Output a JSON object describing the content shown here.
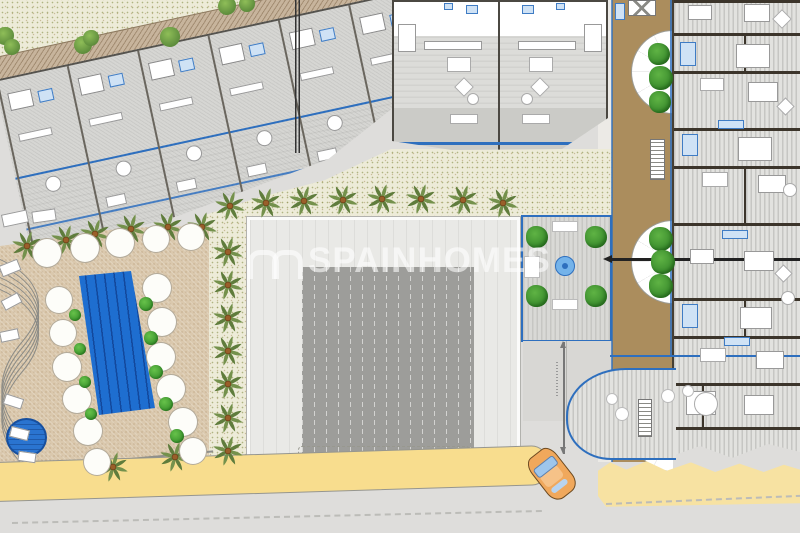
{
  "meta": {
    "kind": "architectural-site-plan",
    "width": 800,
    "height": 533
  },
  "watermark": {
    "text": "SPAINHOMES",
    "logo": "double-arch-icon",
    "color": "#ffffff",
    "opacity": 0.58
  },
  "palette": {
    "road": "#dedddb",
    "gravel": "#edebd8",
    "deck": "#dac8ad",
    "walkway": "#c7b49c",
    "roof_light": "#e9e9e6",
    "roof_dark": "#9d9d9a",
    "pool_blue": "#1e6ed0",
    "promenade_yellow": "#f8dd8e",
    "sand": "#f7e2a2",
    "wood_deck": "#ab8d5d",
    "accent_blue": "#2e6fbe",
    "fixture_blue": "#cfe2f5",
    "vegetation_green": "#3f9830",
    "palm_frond": "#74914c",
    "palm_trunk": "#9a5f2a",
    "car_orange": "#f0a85c"
  },
  "features": {
    "palms": [
      [
        230,
        206
      ],
      [
        266,
        203
      ],
      [
        304,
        201
      ],
      [
        343,
        200
      ],
      [
        382,
        199
      ],
      [
        421,
        199
      ],
      [
        463,
        200
      ],
      [
        503,
        203
      ],
      [
        228,
        252
      ],
      [
        228,
        285
      ],
      [
        228,
        318
      ],
      [
        228,
        351
      ],
      [
        228,
        384
      ],
      [
        228,
        418
      ],
      [
        228,
        451
      ],
      [
        27,
        246
      ],
      [
        66,
        240
      ],
      [
        95,
        234
      ],
      [
        131,
        229
      ],
      [
        168,
        227
      ],
      [
        202,
        227
      ],
      [
        113,
        467
      ],
      [
        175,
        457
      ]
    ],
    "umbrellas": [
      [
        46,
        252,
        14
      ],
      [
        84,
        247,
        14
      ],
      [
        119,
        242,
        14
      ],
      [
        155,
        238,
        13
      ],
      [
        190,
        236,
        13
      ],
      [
        58,
        299,
        13
      ],
      [
        62,
        332,
        13
      ],
      [
        66,
        366,
        14
      ],
      [
        76,
        398,
        14
      ],
      [
        87,
        430,
        14
      ],
      [
        96,
        461,
        13
      ],
      [
        156,
        287,
        14
      ],
      [
        161,
        321,
        14
      ],
      [
        160,
        356,
        14
      ],
      [
        170,
        388,
        14
      ],
      [
        182,
        421,
        14
      ],
      [
        192,
        450,
        13
      ]
    ],
    "bushes": [
      [
        75,
        315,
        6
      ],
      [
        80,
        349,
        6
      ],
      [
        85,
        382,
        6
      ],
      [
        91,
        414,
        6
      ],
      [
        146,
        304,
        7
      ],
      [
        151,
        338,
        7
      ],
      [
        156,
        372,
        7
      ],
      [
        166,
        404,
        7
      ],
      [
        177,
        436,
        7
      ]
    ],
    "gravelBushes": [
      [
        5,
        36,
        9
      ],
      [
        12,
        47,
        8
      ],
      [
        83,
        45,
        9
      ],
      [
        91,
        38,
        8
      ],
      [
        170,
        37,
        10
      ],
      [
        227,
        6,
        9
      ],
      [
        247,
        4,
        8
      ]
    ],
    "trees": [
      [
        659,
        54,
        11
      ],
      [
        661,
        78,
        12
      ],
      [
        660,
        102,
        11
      ],
      [
        661,
        239,
        12
      ],
      [
        663,
        262,
        12
      ],
      [
        661,
        286,
        12
      ],
      [
        537,
        237,
        11
      ],
      [
        596,
        237,
        11
      ],
      [
        537,
        296,
        11
      ],
      [
        596,
        296,
        11
      ]
    ],
    "rightWalls": [
      0,
      33,
      71,
      128,
      166,
      223,
      298,
      336,
      383,
      427
    ],
    "rightWallSegs": [
      [
        742,
        33,
        38
      ],
      [
        742,
        166,
        57
      ],
      [
        742,
        298,
        38
      ],
      [
        700,
        383,
        44
      ]
    ],
    "stripUnitCount": 6,
    "stripUnitTemplate": {
      "bed": [
        4,
        14,
        24,
        18
      ],
      "bath": [
        34,
        18,
        15,
        12
      ],
      "kitchen": [
        6,
        56,
        34,
        8
      ],
      "table": [
        22,
        104,
        16,
        16
      ],
      "lounger": [
        6,
        136,
        20,
        11
      ]
    },
    "shapes": [
      [
        "r",
        398,
        24,
        18,
        28,
        0,
        "#ffffff",
        "#999"
      ],
      [
        "r",
        584,
        24,
        18,
        28,
        0,
        "#ffffff",
        "#999"
      ],
      [
        "r",
        424,
        41,
        58,
        9,
        0,
        "#ffffff",
        "#999"
      ],
      [
        "r",
        518,
        41,
        58,
        9,
        0,
        "#ffffff",
        "#999"
      ],
      [
        "r",
        447,
        57,
        24,
        15,
        0,
        "#ffffff",
        "#aaa"
      ],
      [
        "r",
        529,
        57,
        24,
        15,
        0,
        "#ffffff",
        "#aaa"
      ],
      [
        "r",
        457,
        80,
        14,
        14,
        45,
        "#ffffff",
        "#aaa"
      ],
      [
        "r",
        533,
        80,
        14,
        14,
        45,
        "#ffffff",
        "#aaa"
      ],
      [
        "c",
        473,
        99,
        6,
        "#ffffff",
        "#aaa"
      ],
      [
        "c",
        527,
        99,
        6,
        "#ffffff",
        "#aaa"
      ],
      [
        "r",
        450,
        114,
        28,
        10,
        0,
        "#ffffff",
        "#aaa"
      ],
      [
        "r",
        522,
        114,
        28,
        10,
        0,
        "#ffffff",
        "#aaa"
      ],
      [
        "r",
        466,
        5,
        12,
        9,
        0,
        "#cfe2f5",
        "#3f7cc4"
      ],
      [
        "r",
        522,
        5,
        12,
        9,
        0,
        "#cfe2f5",
        "#3f7cc4"
      ],
      [
        "r",
        444,
        3,
        9,
        7,
        0,
        "#cfe2f5",
        "#3f7cc4"
      ],
      [
        "r",
        556,
        3,
        9,
        7,
        0,
        "#cfe2f5",
        "#3f7cc4"
      ],
      [
        "r",
        688,
        5,
        24,
        15,
        0,
        "#ffffff",
        "#999"
      ],
      [
        "r",
        744,
        4,
        26,
        18,
        0,
        "#ffffff",
        "#999"
      ],
      [
        "r",
        775,
        12,
        14,
        14,
        45,
        "#ffffff",
        "#aaa"
      ],
      [
        "r",
        680,
        42,
        16,
        24,
        0,
        "#cfe2f5",
        "#3f7cc4"
      ],
      [
        "r",
        736,
        44,
        34,
        24,
        0,
        "#ffffff",
        "#999"
      ],
      [
        "r",
        700,
        78,
        24,
        13,
        0,
        "#ffffff",
        "#aaa"
      ],
      [
        "r",
        748,
        82,
        30,
        20,
        0,
        "#ffffff",
        "#999"
      ],
      [
        "r",
        779,
        100,
        13,
        13,
        45,
        "#ffffff",
        "#aaa"
      ],
      [
        "r",
        682,
        134,
        16,
        22,
        0,
        "#cfe2f5",
        "#3f7cc4"
      ],
      [
        "r",
        738,
        137,
        34,
        24,
        0,
        "#ffffff",
        "#999"
      ],
      [
        "r",
        702,
        172,
        26,
        15,
        0,
        "#ffffff",
        "#aaa"
      ],
      [
        "r",
        758,
        175,
        28,
        18,
        0,
        "#ffffff",
        "#999"
      ],
      [
        "c",
        790,
        190,
        7,
        "#ffffff",
        "#aaa"
      ],
      [
        "r",
        690,
        249,
        24,
        15,
        0,
        "#ffffff",
        "#999"
      ],
      [
        "r",
        744,
        251,
        30,
        20,
        0,
        "#ffffff",
        "#999"
      ],
      [
        "r",
        777,
        267,
        13,
        13,
        45,
        "#ffffff",
        "#aaa"
      ],
      [
        "r",
        682,
        304,
        16,
        24,
        0,
        "#cfe2f5",
        "#3f7cc4"
      ],
      [
        "r",
        740,
        307,
        32,
        22,
        0,
        "#ffffff",
        "#999"
      ],
      [
        "c",
        788,
        298,
        7,
        "#ffffff",
        "#aaa"
      ],
      [
        "r",
        700,
        348,
        26,
        14,
        0,
        "#ffffff",
        "#aaa"
      ],
      [
        "r",
        756,
        351,
        28,
        18,
        0,
        "#ffffff",
        "#999"
      ],
      [
        "r",
        686,
        391,
        30,
        24,
        0,
        "#ffffff",
        "#999"
      ],
      [
        "r",
        744,
        395,
        30,
        20,
        0,
        "#ffffff",
        "#999"
      ],
      [
        "r",
        718,
        120,
        26,
        9,
        0,
        "#cfe2f5",
        "#3f7cc4"
      ],
      [
        "r",
        722,
        230,
        26,
        9,
        0,
        "#cfe2f5",
        "#3f7cc4"
      ],
      [
        "r",
        724,
        337,
        26,
        9,
        0,
        "#cfe2f5",
        "#3f7cc4"
      ],
      [
        "r",
        615,
        3,
        10,
        17,
        0,
        "#cfe2f5",
        "#3f7cc4"
      ],
      [
        "c",
        612,
        399,
        6,
        "#ffffff",
        "#bbb"
      ],
      [
        "c",
        622,
        414,
        7,
        "#ffffff",
        "#bbb"
      ],
      [
        "c",
        668,
        396,
        7,
        "#ffffff",
        "#bbb"
      ],
      [
        "c",
        688,
        391,
        6,
        "#ffffff",
        "#bbb"
      ],
      [
        "c",
        706,
        404,
        12,
        "#ffffff",
        "#aaa"
      ],
      [
        "r",
        2,
        212,
        26,
        13,
        -12,
        "#ffffff",
        "#999"
      ],
      [
        "r",
        32,
        210,
        24,
        12,
        -8,
        "#ffffff",
        "#999"
      ],
      [
        "r",
        0,
        262,
        20,
        12,
        -22,
        "#ffffff",
        "#999"
      ],
      [
        "r",
        2,
        296,
        19,
        11,
        -28,
        "#ffffff",
        "#999"
      ],
      [
        "r",
        0,
        330,
        19,
        11,
        -12,
        "#ffffff",
        "#999"
      ],
      [
        "r",
        4,
        396,
        19,
        11,
        18,
        "#ffffff",
        "#999"
      ],
      [
        "r",
        10,
        428,
        19,
        11,
        14,
        "#ffffff",
        "#999"
      ],
      [
        "r",
        18,
        452,
        18,
        10,
        8,
        "#ffffff",
        "#999"
      ],
      [
        "r",
        524,
        256,
        16,
        22,
        0,
        "#ffffff",
        "#bbb"
      ],
      [
        "r",
        552,
        221,
        26,
        11,
        0,
        "#ffffff",
        "#bbb"
      ],
      [
        "r",
        552,
        299,
        26,
        11,
        0,
        "#ffffff",
        "#bbb"
      ],
      [
        "c",
        565,
        266,
        10,
        "#74b3ea",
        "#2e6fbe"
      ],
      [
        "c",
        565,
        266,
        3,
        "#2e6fbe",
        ""
      ],
      [
        "r",
        650,
        139,
        15,
        41,
        0,
        "#ffffff",
        "#777",
        "stairs"
      ],
      [
        "r",
        638,
        399,
        14,
        38,
        0,
        "#ffffff",
        "#777",
        "stairs"
      ],
      [
        "r",
        628,
        0,
        28,
        16,
        0,
        "#ffffff",
        "#777",
        "xsq"
      ]
    ]
  }
}
